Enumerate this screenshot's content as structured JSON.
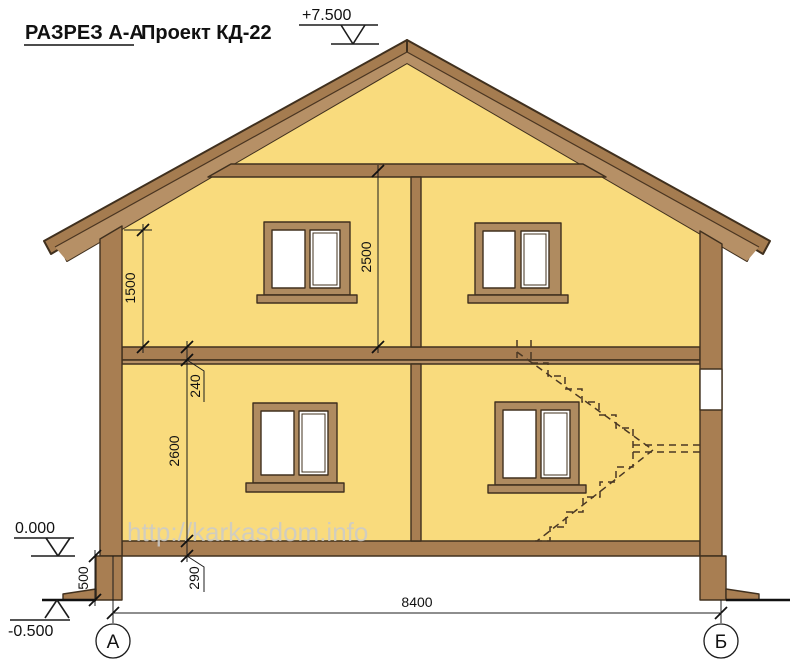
{
  "title": {
    "section": "РАЗРЕЗ  А-А",
    "project": "Проект КД-22"
  },
  "watermark": "http://karkasdom.info",
  "elevations": {
    "ridge": "+7.500",
    "floor_zero": "0.000",
    "ground": "-0.500"
  },
  "dimensions": {
    "knee_wall_height": "1500",
    "second_floor_height": "2500",
    "interfloor_thickness": "240",
    "first_floor_height": "2600",
    "plinth_height": "500",
    "floor_platform": "290",
    "total_width": "8400"
  },
  "axes": {
    "left": "А",
    "right": "Б"
  },
  "colors": {
    "wall_fill": "#f9db7d",
    "wood": "#a87e52",
    "roof_outer": "#a57c50",
    "roof_inner": "#b69066",
    "window_frame": "#af8b60",
    "outline": "#40301e",
    "dim": "#1c1c1c",
    "watermark": "#cbcbcb"
  }
}
